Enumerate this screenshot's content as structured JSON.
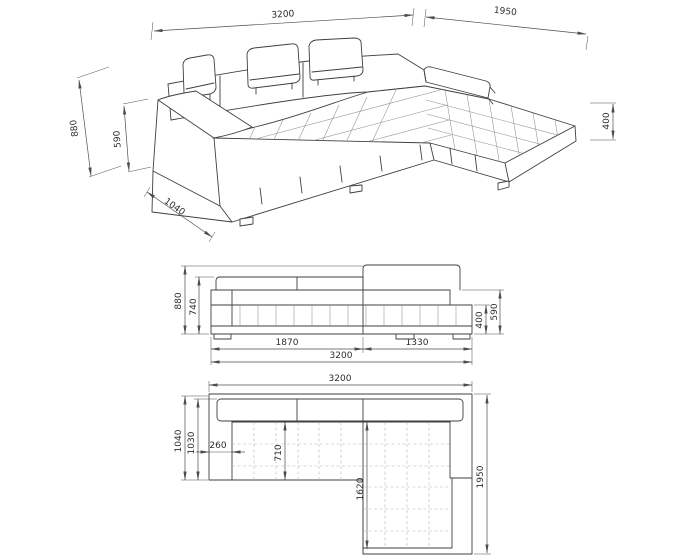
{
  "drawing": {
    "subject": "corner-sofa-technical-drawing"
  },
  "views": {
    "perspective": {
      "dims": {
        "width": "3200",
        "chaise_depth": "1950",
        "total_height": "880",
        "armrest_height": "590",
        "seat_height": "400",
        "depth": "1040"
      }
    },
    "front": {
      "dims": {
        "total_height": "880",
        "back_height": "740",
        "armrest_height": "590",
        "seat_height": "400",
        "sofa_width": "1870",
        "chaise_width": "1330",
        "total_width": "3200"
      }
    },
    "plan": {
      "dims": {
        "total_width": "3200",
        "depth": "1040",
        "inner_depth": "1030",
        "armrest_width": "260",
        "seat_depth": "710",
        "chaise_length": "1620",
        "total_depth": "1950"
      }
    }
  },
  "colors": {
    "outline": "#3f3f3f",
    "dimension": "#4d4d4d",
    "grid": "#b3b3b3",
    "background": "#ffffff"
  }
}
